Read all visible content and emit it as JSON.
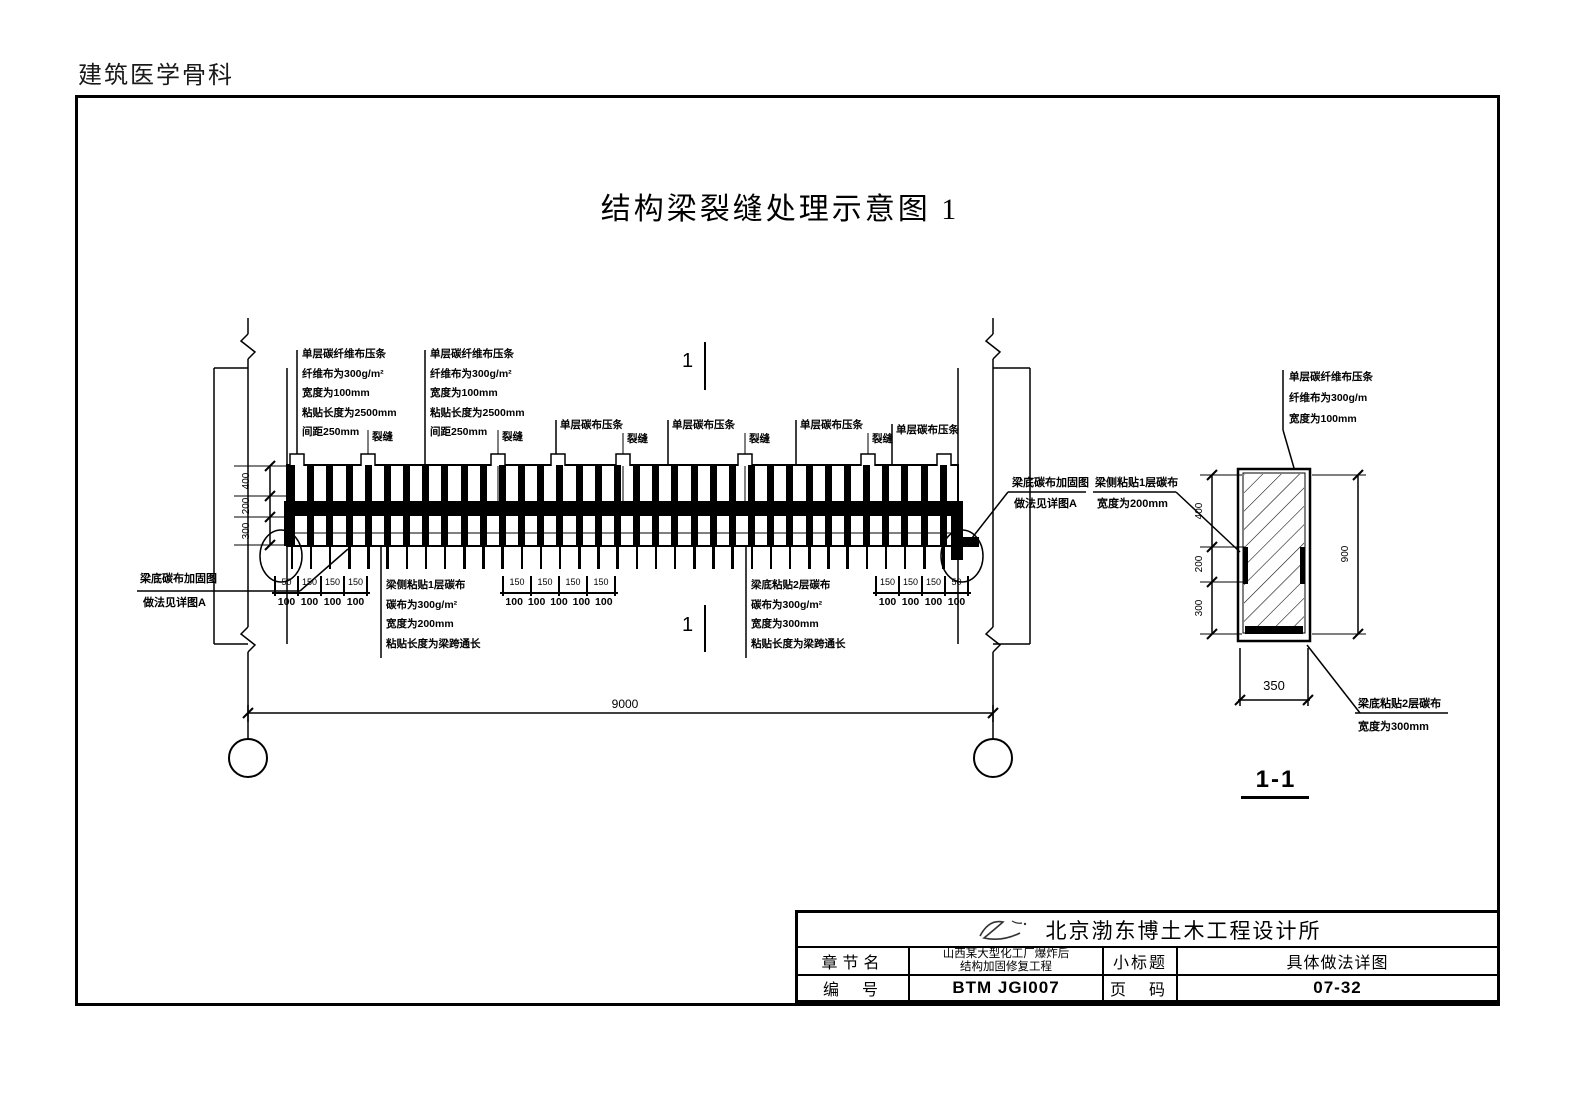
{
  "colors": {
    "ink": "#000000",
    "paper": "#ffffff"
  },
  "page": {
    "corner_label": "建筑医学骨科",
    "title": "结构梁裂缝处理示意图 1"
  },
  "elevation": {
    "strip_note": {
      "lines": [
        "单层碳纤维布压条",
        "纤维布为300g/m²",
        "宽度为100mm",
        "粘贴长度为2500mm",
        "间距250mm"
      ]
    },
    "strip_label": "单层碳布压条",
    "crack_label": "裂缝",
    "section_marker": "1",
    "side_note": {
      "lines": [
        "梁侧粘贴1层碳布",
        "碳布为300g/m²",
        "宽度为200mm",
        "粘贴长度为梁跨通长"
      ]
    },
    "bottom_note": {
      "lines": [
        "梁底粘贴2层碳布",
        "碳布为300g/m²",
        "宽度为300mm",
        "粘贴长度为梁跨通长"
      ]
    },
    "detail_callout": {
      "line1": "梁底碳布加固图",
      "line2": "做法见详图A"
    },
    "side_callout": {
      "line1": "梁侧粘贴1层碳布",
      "line2": "宽度为200mm"
    },
    "dims": {
      "chain_left": [
        "400",
        "200",
        "300"
      ],
      "span": "9000",
      "group1": {
        "top": [
          "50",
          "150",
          "150",
          "150"
        ],
        "bottom": [
          "100",
          "100",
          "100",
          "100"
        ]
      },
      "group2": {
        "top": [
          "150",
          "150",
          "150",
          "150"
        ],
        "bottom": [
          "100",
          "100",
          "100",
          "100",
          "100"
        ]
      },
      "group3": {
        "top": [
          "150",
          "150",
          "150",
          "50"
        ],
        "bottom": [
          "100",
          "100",
          "100",
          "100"
        ]
      }
    }
  },
  "section": {
    "title": "1-1",
    "top_note": {
      "lines": [
        "单层碳纤维布压条",
        "纤维布为300g/m",
        "宽度为100mm"
      ]
    },
    "bottom_note": {
      "lines": [
        "梁底粘贴2层碳布",
        "宽度为300mm"
      ]
    },
    "dims": {
      "chain_left": [
        "400",
        "200",
        "300"
      ],
      "height": "900",
      "width": "350"
    }
  },
  "titleblock": {
    "company": "北京渤东博土木工程设计所",
    "chapter_label": "章节名",
    "project_line1": "山西某大型化工厂爆炸后",
    "project_line2": "结构加固修复工程",
    "subtitle_label": "小标题",
    "subtitle_value": "具体做法详图",
    "number_label": "编  号",
    "number_value": "BTM JGI007",
    "page_label": "页  码",
    "page_value": "07-32"
  }
}
